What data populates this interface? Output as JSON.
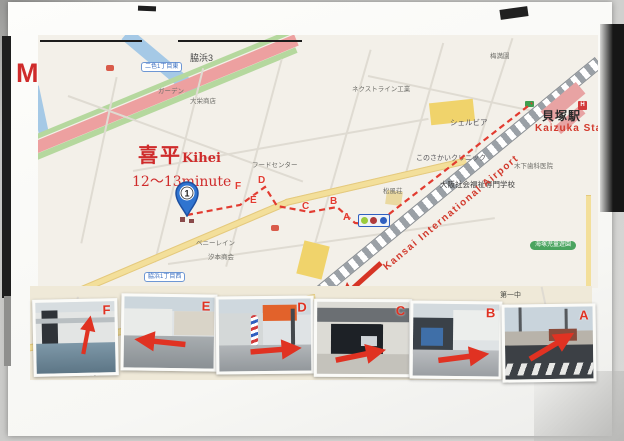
{
  "page": {
    "title": "MAP"
  },
  "destination": {
    "name_jp": "喜平",
    "name_en": "Kihei",
    "walk_time": "12～13minute",
    "marker_number": "1"
  },
  "station": {
    "name_jp": "貝塚駅",
    "name_en": "Kaizuka Stati"
  },
  "airport_label": "Kansai International Airport",
  "map": {
    "area_labels": [
      {
        "text": "脇浜3"
      },
      {
        "text": "梅満園"
      },
      {
        "text": "ガーデン"
      },
      {
        "text": "大栄商店"
      },
      {
        "text": "ネクストライン工業"
      },
      {
        "text": "シェルビア"
      },
      {
        "text": "このさかいクリニック"
      },
      {
        "text": "大阪社会福祉専門学校"
      },
      {
        "text": "木下歯科医院"
      },
      {
        "text": "フードセンター"
      },
      {
        "text": "松風荘"
      },
      {
        "text": "ベニーレイン"
      },
      {
        "text": "汐本商会"
      }
    ],
    "road_signs": [
      {
        "text": "二色1丁目東"
      },
      {
        "text": "脇浜1丁目西"
      }
    ],
    "park_label": "海塚児童遊園",
    "hospital_icon": "H",
    "route_letters": [
      {
        "letter": "A"
      },
      {
        "letter": "B"
      },
      {
        "letter": "C"
      },
      {
        "letter": "D"
      },
      {
        "letter": "E"
      },
      {
        "letter": "F"
      }
    ]
  },
  "strip": {
    "label_top": "第一中",
    "label_left": "西小",
    "attribution": "地図データ ©ZENRIN"
  },
  "photos": [
    {
      "letter": "F"
    },
    {
      "letter": "E"
    },
    {
      "letter": "D"
    },
    {
      "letter": "C"
    },
    {
      "letter": "B"
    },
    {
      "letter": "A"
    }
  ],
  "colors": {
    "accent_red": "#cf2b2b",
    "route_red": "#e23b30",
    "pin_blue": "#2f74d0",
    "station_pink": "#e8a3a3",
    "park_green": "#4aa45f",
    "highway_pink": "#eda0a0",
    "water_blue": "#a5c9e6",
    "road_yellow": "#f3df9a"
  }
}
